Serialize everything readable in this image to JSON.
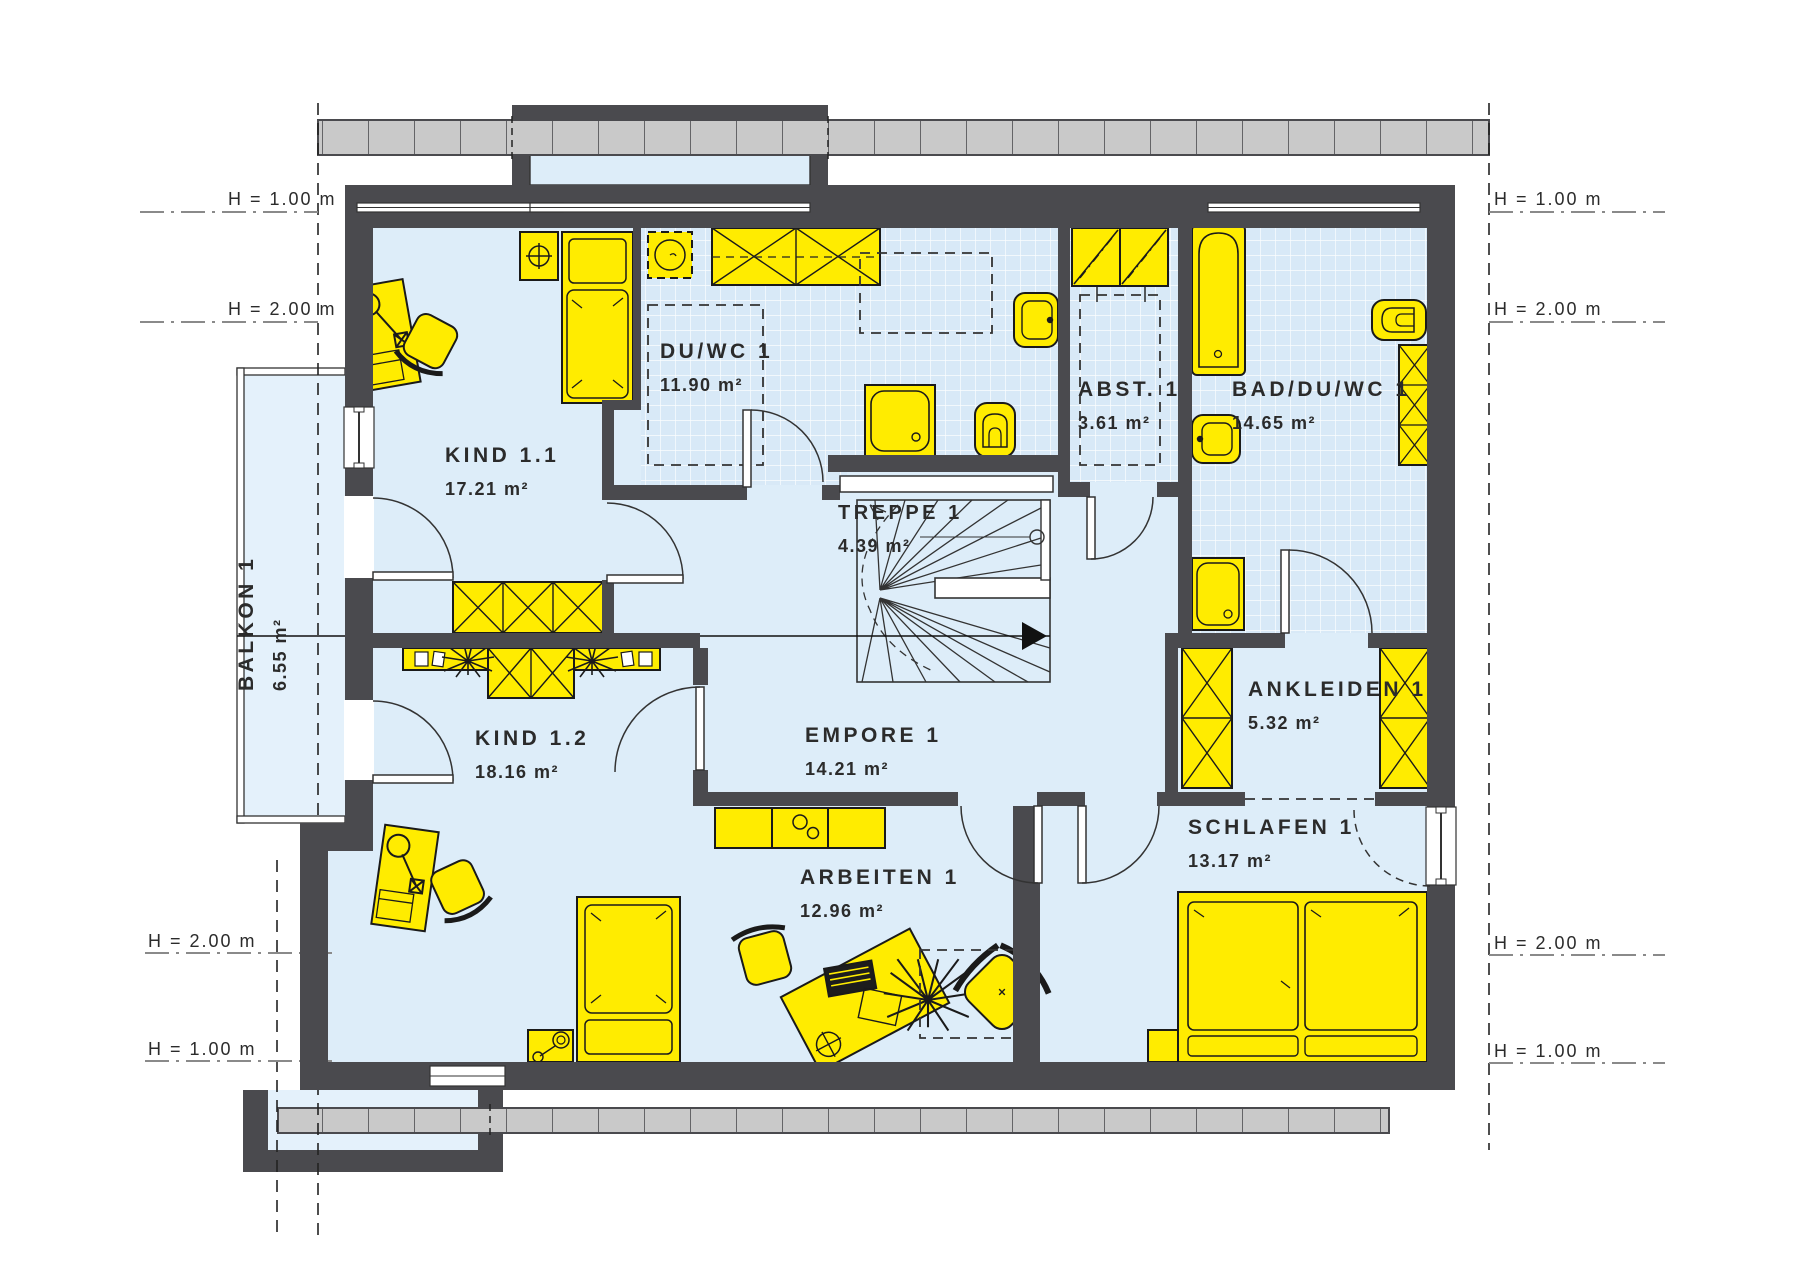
{
  "plan_title": "Obergeschoss Grundriss",
  "rooms": [
    {
      "id": "kind-1-1",
      "name": "KIND 1.1",
      "area": "17.21 m²"
    },
    {
      "id": "kind-1-2",
      "name": "KIND 1.2",
      "area": "18.16 m²"
    },
    {
      "id": "du-wc-1",
      "name": "DU/WC 1",
      "area": "11.90 m²"
    },
    {
      "id": "treppe-1",
      "name": "TREPPE 1",
      "area": "4.39 m²"
    },
    {
      "id": "abst-1",
      "name": "ABST. 1",
      "area": "3.61 m²"
    },
    {
      "id": "bad-du-wc-1",
      "name": "BAD/DU/WC 1",
      "area": "14.65 m²"
    },
    {
      "id": "ankleiden-1",
      "name": "ANKLEIDEN 1",
      "area": "5.32 m²"
    },
    {
      "id": "schlafen-1",
      "name": "SCHLAFEN 1",
      "area": "13.17 m²"
    },
    {
      "id": "empore-1",
      "name": "EMPORE 1",
      "area": "14.21 m²"
    },
    {
      "id": "arbeiten-1",
      "name": "ARBEITEN 1",
      "area": "12.96 m²"
    },
    {
      "id": "balkon-1",
      "name": "BALKON 1",
      "area": "6.55 m²"
    }
  ],
  "height_markers": {
    "left": [
      {
        "label": "H = 1.00 m"
      },
      {
        "label": "H = 2.00 m"
      },
      {
        "label": "H = 2.00 m"
      },
      {
        "label": "H = 1.00 m"
      }
    ],
    "right": [
      {
        "label": "H = 1.00 m"
      },
      {
        "label": "H = 2.00 m"
      },
      {
        "label": "H = 2.00 m"
      },
      {
        "label": "H = 1.00 m"
      }
    ]
  },
  "colors": {
    "wall": "#4a4a4e",
    "floor": "#ddedf9",
    "tile": "#d8e9f7",
    "furniture": "#ffec00",
    "roof_band": "#c9c9c9"
  }
}
